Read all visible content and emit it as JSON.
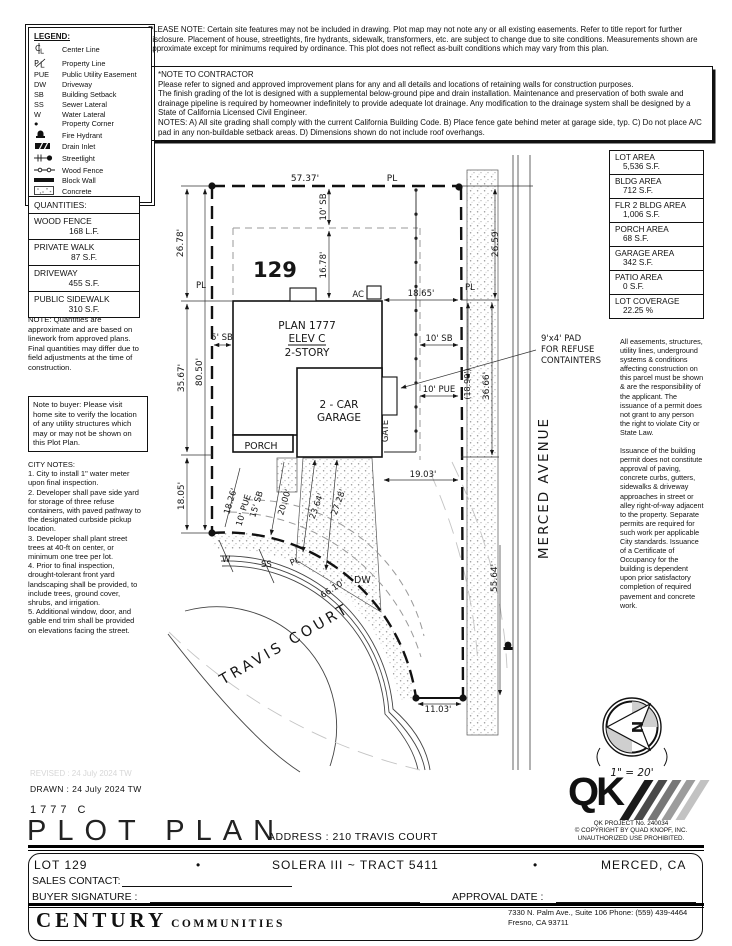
{
  "please_note": "PLEASE NOTE:  Certain site features may not be included in drawing.  Plot map may not note any or all existing easements. Refer to title report for further disclosure.  Placement of house, streetlights, fire hydrants, sidewalk, transformers, etc. are subject to change due to site conditions.  Measurements shown are approximate except for minimums required by ordinance.  This plot does not reflect as-built conditions which may vary from this plan.",
  "contractor": {
    "title": "*NOTE TO CONTRACTOR",
    "body": "Please refer to signed and approved improvement plans for any and all details and locations of retaining walls for construction purposes.\nThe finish grading of the lot is designed with a supplemental below-ground pipe and drain installation.  Maintenance and preservation of both swale and drainage pipeline is required by homeowner indefinitely to provide adequate lot drainage.  Any modification to the drainage system shall be designed by a State of California Licensed Civil Engineer.\nNOTES:  A) All site grading shall comply with the current California Building Code.  B) Place fence gate behind meter at garage side, typ.  C) Do not place A/C pad in any non-buildable setback areas.  D) Dimensions shown do not include roof overhangs."
  },
  "legend": {
    "title": "LEGEND:",
    "items": [
      {
        "sym": "",
        "label": "Center Line"
      },
      {
        "sym": "",
        "label": "Property Line"
      },
      {
        "sym": "PUE",
        "label": "Public Utility Easement"
      },
      {
        "sym": "DW",
        "label": "Driveway"
      },
      {
        "sym": "SB",
        "label": "Building Setback"
      },
      {
        "sym": "SS",
        "label": "Sewer Lateral"
      },
      {
        "sym": "W",
        "label": "Water Lateral"
      },
      {
        "sym": "●",
        "label": "Property Corner"
      },
      {
        "sym": "",
        "label": "Fire Hydrant"
      },
      {
        "sym": "",
        "label": "Drain Inlet"
      },
      {
        "sym": "",
        "label": "Streetlight"
      },
      {
        "sym": "",
        "label": "Wood Fence"
      },
      {
        "sym": "",
        "label": "Block Wall"
      },
      {
        "sym": "",
        "label": "Concrete"
      }
    ]
  },
  "quantities": {
    "title": "QUANTITIES:",
    "rows": [
      {
        "name": "WOOD FENCE",
        "value": "168 L.F."
      },
      {
        "name": "PRIVATE WALK",
        "value": "87 S.F."
      },
      {
        "name": "DRIVEWAY",
        "value": "455 S.F."
      },
      {
        "name": "PUBLIC SIDEWALK",
        "value": "310 S.F."
      }
    ],
    "note": "NOTE: Quantities are approximate and are based on linework from approved plans.  Final quantities may differ due to field adjustments at the time of construction."
  },
  "buyer_note": "Note to buyer: Please visit home site to verify the location of any utility structures which may or may not be shown on this Plot Plan.",
  "city_notes": {
    "title": "CITY NOTES:",
    "body": "1. City to install 1\" water meter upon final inspection.\n2. Developer shall pave side yard for storage of three refuse containers, with paved pathway to the designated curbside pickup location.\n3. Developer shall plant street trees at 40-ft on center, or minimum one tree per lot.\n4. Prior to final inspection, drought-tolerant front yard landscaping shall be provided, to include trees, ground cover, shrubs, and irrigation.\n5. Additional window, door, and gable end trim shall be provided on elevations facing the street."
  },
  "areas": {
    "rows": [
      {
        "label": "LOT AREA",
        "value": "5,536 S.F."
      },
      {
        "label": "BLDG AREA",
        "value": "712 S.F."
      },
      {
        "label": "FLR 2 BLDG AREA",
        "value": "1,006 S.F."
      },
      {
        "label": "PORCH AREA",
        "value": "68 S.F."
      },
      {
        "label": "GARAGE AREA",
        "value": "342 S.F."
      },
      {
        "label": "PATIO AREA",
        "value": "0 S.F."
      },
      {
        "label": "LOT COVERAGE",
        "value": "22.25 %"
      }
    ]
  },
  "easements": {
    "para1": "All easements, structures, utility lines, underground systems & conditions affecting construction on this parcel must be shown & are the responsibility of the applicant. The issuance of a permit does not grant to any person the right to violate City or State Law.",
    "para2": "Issuance of the building permit does not constitute approval of paving, concrete curbs, gutters, sidewalks & driveway approaches in street or alley right-of-way adjacent to the property. Separate permits are required for such work per applicable City standards. Issuance of a Certificate of Occupancy for the building is dependent upon prior satisfactory completion of required pavement and concrete work."
  },
  "drawing": {
    "labels": {
      "pl": "PL",
      "ac": "AC",
      "dw": "DW",
      "w": "W",
      "ss": "SS",
      "gate": "GATE",
      "porch": "PORCH",
      "lot_number": "129",
      "plan1": "PLAN 1777",
      "plan2": "ELEV C",
      "plan3": "2-STORY",
      "garage1": "2 - CAR",
      "garage2": "GARAGE",
      "refuse1": "9'x4' PAD",
      "refuse2": "FOR REFUSE",
      "refuse3": "CONTAINTERS",
      "travis": "TRAVIS COURT",
      "merced": "MERCED AVENUE",
      "north": "N",
      "scale": "1\" = 20'"
    },
    "dims": {
      "top": "57.37'",
      "left1": "26.78'",
      "left2": "35.67'",
      "left3": "18.05'",
      "left_total": "80.50'",
      "sb10_top": "10' SB",
      "d1678": "16.78'",
      "d1865": "18.65'",
      "right_top": "26.59'",
      "sb5": "5' SB",
      "sb10_right": "10' SB",
      "pue10_right": "10' PUE",
      "d1890": "(18.90')",
      "d3666": "36.66'",
      "d1903": "19.03'",
      "d1826": "18.26'",
      "pue10_diag": "10' PUE",
      "sb15": "15' SB",
      "d2000": "20.00'",
      "d2364": "23.64'",
      "d2728": "27.28'",
      "d6610": "66.10'",
      "d5564": "55.64'",
      "d1103": "11.03'"
    }
  },
  "title_block": {
    "revised": "REVISED :  24 July 2024   TW",
    "drawn": "DRAWN :  24 July 2024   TW",
    "plan_code": "1777   C",
    "title": "PLOT PLAN",
    "address": "ADDRESS :  210 TRAVIS COURT",
    "lot": "LOT 129",
    "bullet": "•",
    "tract": "SOLERA III ~ TRACT 5411",
    "city": "MERCED, CA",
    "sales_contact": "SALES CONTACT:",
    "buyer_signature": "BUYER SIGNATURE :",
    "approval_date": "APPROVAL DATE :",
    "builder1": "CENTURY",
    "builder2": "COMMUNITIES",
    "office_line1": "7330 N. Palm Ave., Suite 106    Phone:  (559) 439-4464",
    "office_line2": "Fresno, CA  93711",
    "qk": {
      "letters": "QK",
      "line1": "QK PROJECT No. 240034",
      "line2": "©   COPYRIGHT BY QUAD KNOPF, INC.",
      "line3": "UNAUTHORIZED USE PROHIBITED."
    }
  }
}
